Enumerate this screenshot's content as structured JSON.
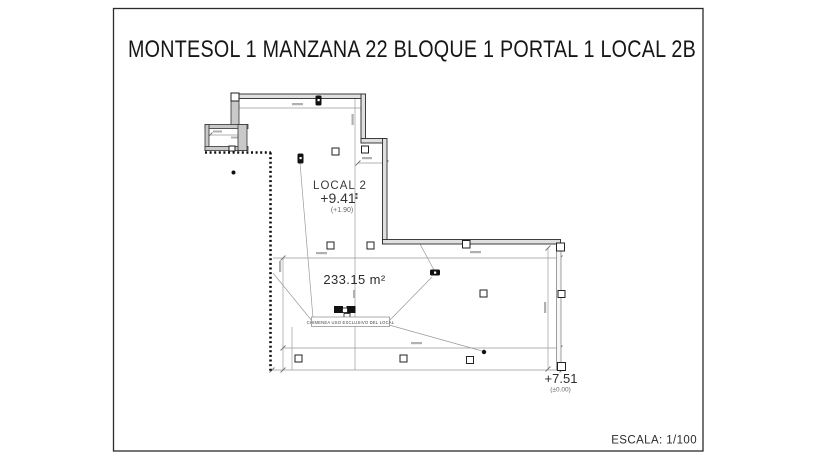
{
  "page": {
    "title": "MONTESOL 1 MANZANA 22 BLOQUE 1 PORTAL 1 LOCAL 2B",
    "scale_label": "ESCALA: 1/100"
  },
  "plan": {
    "room_label": "LOCAL 2",
    "room_elevation": "+9.41",
    "room_elevation_note": "(+1.90)",
    "area_label": "233.15 m²",
    "chimney_note": "CHIMENEA USO EXCLUSIVO DEL LOCAL",
    "access_elevation": "+7.51",
    "access_elevation_note": "(±0.00)"
  },
  "colors": {
    "ink": "#2b2b2b",
    "thin_line": "#999999",
    "wall_fill": "#e0e0e0",
    "hatch_fill": "#c9c9c9",
    "background": "#ffffff"
  }
}
